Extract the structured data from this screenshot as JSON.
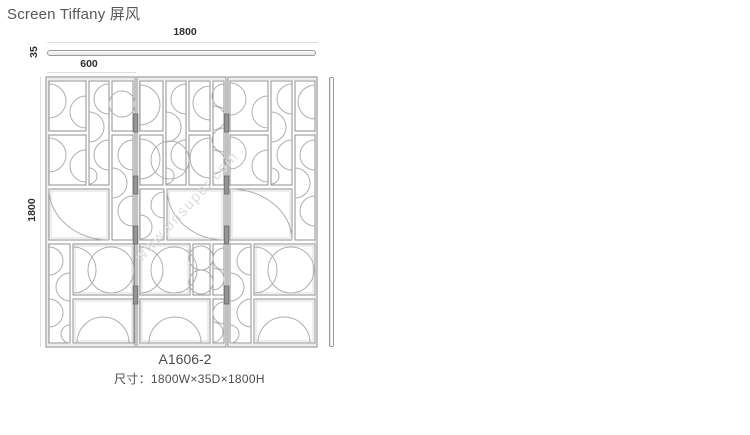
{
  "page": {
    "title": "Screen Tiffany 屏风"
  },
  "dimensions": {
    "overall_width": "1800",
    "depth": "35",
    "panel_width": "600",
    "overall_height": "1800"
  },
  "product": {
    "code": "A1606-2",
    "size": "尺寸：1800W×35D×1800H"
  },
  "watermark": {
    "text": "www.unsuper.com"
  },
  "drawing": {
    "panel_count": 3,
    "views": [
      "top",
      "front",
      "side"
    ]
  },
  "colors": {
    "frame_line": "#8f8f8f",
    "arc_line": "#aeaeae",
    "dim_line": "#dcdcdc",
    "dim_text": "#2f2f2f",
    "body_text": "#4d4d4d",
    "title_text": "#585858",
    "watermark_text": "#dedede",
    "hinge": "#949494",
    "background": "#ffffff"
  }
}
